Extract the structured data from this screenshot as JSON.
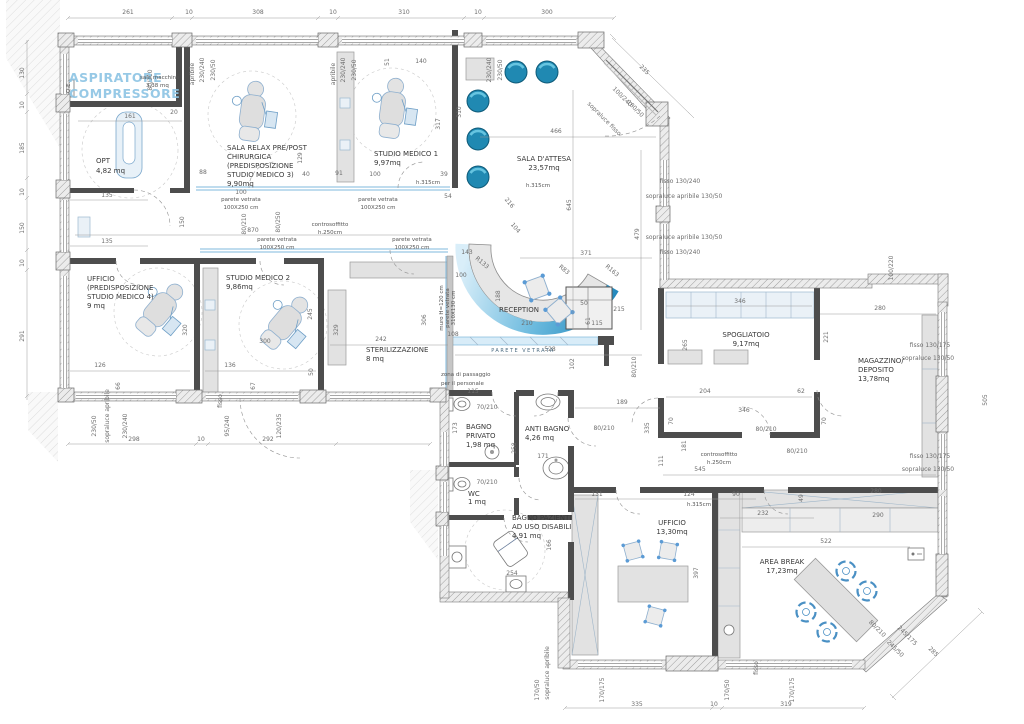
{
  "drawing": {
    "type": "architectural floor plan",
    "subject": "studio dentistico / medico",
    "units": "cm"
  },
  "colors": {
    "wall_dark": "#4d4d4d",
    "accent_blue": "#2e93c9",
    "chair_blue": "#2089b2",
    "glass_blue": "#7fb8dc",
    "aspiratore_text": "#8cc4e4",
    "dim_text": "#6d6d6d"
  },
  "rooms": {
    "sala_macchine": {
      "lines": [
        "ASPIRATORE",
        "COMPRESSORE"
      ],
      "sub": [
        "sala macchine",
        "3,38 mq"
      ]
    },
    "opt": {
      "name": "OPT",
      "area": "4,82 mq"
    },
    "sala_relax": {
      "lines": [
        "SALA RELAX PRE/POST",
        "CHIRURGICA",
        "(PREDISPOSIZIONE",
        "STUDIO MEDICO 3)",
        "9,90mq"
      ]
    },
    "studio1": {
      "name": "STUDIO MEDICO 1",
      "area": "9,97mq"
    },
    "sala_attesa": {
      "name": "SALA D'ATTESA",
      "area": "23,57mq"
    },
    "ufficio_predisp": {
      "lines": [
        "UFFICIO",
        "(PREDISPOSIZIONE",
        "STUDIO MEDICO 4)",
        "9 mq"
      ]
    },
    "studio2": {
      "name": "STUDIO MEDICO 2",
      "area": "9,86mq"
    },
    "sterilizzazione": {
      "name": "STERILIZZAZIONE",
      "area": "8 mq"
    },
    "reception": {
      "name": "RECEPTION"
    },
    "spogliatoio": {
      "name": "SPOGLIATOIO",
      "area": "9,17mq"
    },
    "magazzino": {
      "lines": [
        "MAGAZZINO/",
        "DEPOSITO",
        "13,78mq"
      ]
    },
    "bagno_privato": {
      "lines": [
        "BAGNO",
        "PRIVATO",
        "1,98 mq"
      ]
    },
    "anti_bagno": {
      "name": "ANTI BAGNO",
      "area": "4,26 mq"
    },
    "wc": {
      "name": "WC",
      "area": "1 mq"
    },
    "bagno_pazienti": {
      "lines": [
        "BAGNO PAZIENTI",
        "AD USO DISABILI",
        "4,91 mq"
      ]
    },
    "ufficio2": {
      "name": "UFFICIO",
      "area": "13,30mq"
    },
    "area_break": {
      "name": "AREA BREAK",
      "area": "17,23mq"
    }
  },
  "annotations": {
    "qe": "Q.E.",
    "h315": "h.315cm",
    "parete_vetrata": {
      "l1": "parete vetrata",
      "l2": "100X250 cm"
    },
    "parete_vetrata_caps": "PARETE VETRATA",
    "muro": {
      "l1": "muro H=120 cm",
      "l2": "parete vetrata",
      "l3": "310X130 cm"
    },
    "zona": {
      "l1": "zona di passaggio",
      "l2": "per il personale"
    },
    "controsoffitto": {
      "l1": "controsoffitto",
      "l2": "h.250cm"
    }
  },
  "dims": [
    {
      "x": 128,
      "y": 14,
      "t": "261"
    },
    {
      "x": 189,
      "y": 14,
      "t": "10"
    },
    {
      "x": 258,
      "y": 14,
      "t": "308"
    },
    {
      "x": 333,
      "y": 14,
      "t": "10"
    },
    {
      "x": 404,
      "y": 14,
      "t": "310"
    },
    {
      "x": 478,
      "y": 14,
      "t": "10"
    },
    {
      "x": 547,
      "y": 14,
      "t": "300"
    },
    {
      "x": 24,
      "y": 73,
      "t": "130",
      "r": -90
    },
    {
      "x": 24,
      "y": 105,
      "t": "10",
      "r": -90
    },
    {
      "x": 24,
      "y": 148,
      "t": "185",
      "r": -90
    },
    {
      "x": 24,
      "y": 192,
      "t": "10",
      "r": -90
    },
    {
      "x": 24,
      "y": 228,
      "t": "150",
      "r": -90
    },
    {
      "x": 24,
      "y": 263,
      "t": "10",
      "r": -90
    },
    {
      "x": 24,
      "y": 336,
      "t": "291",
      "r": -90
    },
    {
      "x": 134,
      "y": 441,
      "t": "298"
    },
    {
      "x": 201,
      "y": 441,
      "t": "10"
    },
    {
      "x": 268,
      "y": 441,
      "t": "292"
    },
    {
      "x": 96,
      "y": 426,
      "t": "230/50",
      "r": -90,
      "s": 5
    },
    {
      "x": 127,
      "y": 426,
      "t": "230/240",
      "r": -90,
      "s": 5
    },
    {
      "x": 229,
      "y": 426,
      "t": "95/240",
      "r": -90,
      "s": 5
    },
    {
      "x": 281,
      "y": 426,
      "t": "120/235",
      "r": -90,
      "s": 5
    },
    {
      "x": 109,
      "y": 416,
      "t": "sopraluce apribile",
      "r": -90,
      "s": 4
    },
    {
      "x": 222,
      "y": 401,
      "t": "fisso",
      "r": -90,
      "s": 4
    },
    {
      "x": 637,
      "y": 706,
      "t": "335"
    },
    {
      "x": 714,
      "y": 706,
      "t": "10"
    },
    {
      "x": 786,
      "y": 706,
      "t": "319"
    },
    {
      "x": 539,
      "y": 690,
      "t": "170/50",
      "r": -90,
      "s": 5
    },
    {
      "x": 604,
      "y": 690,
      "t": "170/175",
      "r": -90,
      "s": 5
    },
    {
      "x": 729,
      "y": 690,
      "t": "170/50",
      "r": -90,
      "s": 5
    },
    {
      "x": 794,
      "y": 690,
      "t": "170/175",
      "r": -90,
      "s": 5
    },
    {
      "x": 549,
      "y": 673,
      "t": "sopraluce apribile",
      "r": -90,
      "s": 4
    },
    {
      "x": 758,
      "y": 668,
      "t": "fisso",
      "r": -90,
      "s": 4
    },
    {
      "x": 204,
      "y": 70,
      "t": "230/240",
      "r": -90,
      "s": 4.5
    },
    {
      "x": 215,
      "y": 70,
      "t": "230/50",
      "r": -90,
      "s": 4.5
    },
    {
      "x": 345,
      "y": 70,
      "t": "230/240",
      "r": -90,
      "s": 4.5
    },
    {
      "x": 356,
      "y": 70,
      "t": "230/50",
      "r": -90,
      "s": 4.5
    },
    {
      "x": 491,
      "y": 70,
      "t": "230/240",
      "r": -90,
      "s": 4.5
    },
    {
      "x": 502,
      "y": 70,
      "t": "230/50",
      "r": -90,
      "s": 4.5
    },
    {
      "x": 194,
      "y": 74,
      "t": "apribile",
      "r": -90,
      "s": 4
    },
    {
      "x": 335,
      "y": 74,
      "t": "apribile",
      "r": -90,
      "s": 4
    },
    {
      "x": 643,
      "y": 71,
      "t": "235",
      "r": 45
    },
    {
      "x": 621,
      "y": 98,
      "t": "100/240",
      "r": 45,
      "s": 4.5
    },
    {
      "x": 634,
      "y": 110,
      "t": "180/50",
      "r": 45,
      "s": 4.5
    },
    {
      "x": 603,
      "y": 120,
      "t": "sopraluce fisso",
      "r": 45,
      "s": 4
    },
    {
      "x": 680,
      "y": 183,
      "t": "fisso 130/240",
      "s": 5
    },
    {
      "x": 684,
      "y": 198,
      "t": "sopraluce apribile 130/50",
      "s": 4.5
    },
    {
      "x": 684,
      "y": 239,
      "t": "sopraluce apribile 130/50",
      "s": 4.5
    },
    {
      "x": 680,
      "y": 254,
      "t": "fisso 130/240",
      "s": 5
    },
    {
      "x": 930,
      "y": 347,
      "t": "fisso 130/175",
      "s": 5,
      "a": "start"
    },
    {
      "x": 928,
      "y": 360,
      "t": "sopraluce 130/50",
      "s": 4.5,
      "a": "start"
    },
    {
      "x": 930,
      "y": 458,
      "t": "fisso 130/175",
      "s": 5,
      "a": "start"
    },
    {
      "x": 928,
      "y": 471,
      "t": "sopraluce 130/50",
      "s": 4.5,
      "a": "start"
    },
    {
      "x": 987,
      "y": 400,
      "t": "505",
      "r": -90
    },
    {
      "x": 893,
      "y": 268,
      "t": "100/220",
      "r": -90,
      "s": 4.5
    },
    {
      "x": 932,
      "y": 653,
      "t": "285",
      "r": 45
    },
    {
      "x": 906,
      "y": 637,
      "t": "245/175",
      "r": 45,
      "s": 4.5
    },
    {
      "x": 894,
      "y": 650,
      "t": "245/50",
      "r": 45,
      "s": 4.5
    },
    {
      "x": 876,
      "y": 630,
      "t": "80/210",
      "r": 45,
      "s": 4.5
    },
    {
      "x": 571,
      "y": 205,
      "t": "645",
      "r": -90
    },
    {
      "x": 639,
      "y": 234,
      "t": "479",
      "r": -90
    },
    {
      "x": 461,
      "y": 112,
      "t": "310",
      "r": -90,
      "s": 5
    },
    {
      "x": 440,
      "y": 124,
      "t": "317",
      "r": -90,
      "s": 5
    },
    {
      "x": 426,
      "y": 320,
      "t": "306",
      "r": -90
    },
    {
      "x": 338,
      "y": 330,
      "t": "329",
      "r": -90
    },
    {
      "x": 187,
      "y": 330,
      "t": "320",
      "r": -90
    },
    {
      "x": 312,
      "y": 314,
      "t": "245",
      "r": -90
    },
    {
      "x": 120,
      "y": 386,
      "t": "66",
      "r": -90,
      "s": 5
    },
    {
      "x": 255,
      "y": 386,
      "t": "67",
      "r": -90,
      "s": 5
    },
    {
      "x": 313,
      "y": 372,
      "t": "50",
      "r": -90,
      "s": 5
    },
    {
      "x": 184,
      "y": 222,
      "t": "150",
      "r": -90
    },
    {
      "x": 500,
      "y": 296,
      "t": "188",
      "r": -90,
      "s": 5
    },
    {
      "x": 574,
      "y": 364,
      "t": "102",
      "r": -90,
      "s": 5
    },
    {
      "x": 590,
      "y": 321,
      "t": "61",
      "r": -90,
      "s": 5
    },
    {
      "x": 649,
      "y": 428,
      "t": "335",
      "r": -90
    },
    {
      "x": 686,
      "y": 446,
      "t": "181",
      "r": -90,
      "s": 5
    },
    {
      "x": 663,
      "y": 461,
      "t": "111",
      "r": -90,
      "s": 5
    },
    {
      "x": 687,
      "y": 345,
      "t": "265",
      "r": -90
    },
    {
      "x": 828,
      "y": 337,
      "t": "221",
      "r": -90
    },
    {
      "x": 698,
      "y": 573,
      "t": "397",
      "r": -90
    },
    {
      "x": 803,
      "y": 498,
      "t": "49",
      "r": -90,
      "s": 5
    },
    {
      "x": 551,
      "y": 545,
      "t": "166",
      "r": -90,
      "s": 5
    },
    {
      "x": 457,
      "y": 428,
      "t": "173",
      "r": -90,
      "s": 5
    },
    {
      "x": 516,
      "y": 448,
      "t": "258",
      "r": -90,
      "s": 5
    },
    {
      "x": 246,
      "y": 224,
      "t": "80/210",
      "r": -90,
      "s": 4.5
    },
    {
      "x": 280,
      "y": 222,
      "t": "80/250",
      "r": -90,
      "s": 4.5
    },
    {
      "x": 152,
      "y": 80,
      "t": "80/210",
      "r": -90,
      "s": 4.5
    },
    {
      "x": 636,
      "y": 367,
      "t": "80/210",
      "r": -90,
      "s": 4.5
    },
    {
      "x": 130,
      "y": 118,
      "t": "161"
    },
    {
      "x": 174,
      "y": 114,
      "t": "20",
      "s": 5
    },
    {
      "x": 107,
      "y": 197,
      "t": "135"
    },
    {
      "x": 107,
      "y": 243,
      "t": "135"
    },
    {
      "x": 253,
      "y": 232,
      "t": "870"
    },
    {
      "x": 241,
      "y": 194,
      "t": "100",
      "s": 5
    },
    {
      "x": 375,
      "y": 176,
      "t": "100",
      "s": 5
    },
    {
      "x": 421,
      "y": 63,
      "t": "140"
    },
    {
      "x": 389,
      "y": 62,
      "t": "51",
      "r": -90,
      "s": 5
    },
    {
      "x": 203,
      "y": 174,
      "t": "88",
      "s": 5
    },
    {
      "x": 306,
      "y": 176,
      "t": "40",
      "s": 5
    },
    {
      "x": 339,
      "y": 175,
      "t": "91",
      "s": 5
    },
    {
      "x": 302,
      "y": 158,
      "t": "129",
      "r": -90,
      "s": 5
    },
    {
      "x": 444,
      "y": 176,
      "t": "39",
      "s": 5
    },
    {
      "x": 448,
      "y": 198,
      "t": "54",
      "s": 5
    },
    {
      "x": 556,
      "y": 133,
      "t": "466"
    },
    {
      "x": 586,
      "y": 255,
      "t": "371"
    },
    {
      "x": 467,
      "y": 254,
      "t": "143",
      "s": 5
    },
    {
      "x": 461,
      "y": 277,
      "t": "100",
      "s": 5
    },
    {
      "x": 381,
      "y": 341,
      "t": "242"
    },
    {
      "x": 527,
      "y": 325,
      "t": "210",
      "s": 5
    },
    {
      "x": 597,
      "y": 325,
      "t": "115",
      "s": 5
    },
    {
      "x": 584,
      "y": 305,
      "t": "50",
      "s": 5
    },
    {
      "x": 619,
      "y": 311,
      "t": "215"
    },
    {
      "x": 550,
      "y": 351,
      "t": "528"
    },
    {
      "x": 453,
      "y": 336,
      "t": "108",
      "s": 5
    },
    {
      "x": 622,
      "y": 404,
      "t": "189"
    },
    {
      "x": 705,
      "y": 393,
      "t": "204"
    },
    {
      "x": 801,
      "y": 393,
      "t": "62"
    },
    {
      "x": 740,
      "y": 303,
      "t": "346"
    },
    {
      "x": 744,
      "y": 412,
      "t": "346"
    },
    {
      "x": 673,
      "y": 421,
      "t": "70",
      "r": -90,
      "s": 5
    },
    {
      "x": 826,
      "y": 421,
      "t": "70",
      "r": -90,
      "s": 5
    },
    {
      "x": 700,
      "y": 471,
      "t": "545"
    },
    {
      "x": 597,
      "y": 496,
      "t": "131"
    },
    {
      "x": 689,
      "y": 496,
      "t": "124"
    },
    {
      "x": 736,
      "y": 496,
      "t": "90"
    },
    {
      "x": 763,
      "y": 515,
      "t": "232"
    },
    {
      "x": 880,
      "y": 310,
      "t": "280"
    },
    {
      "x": 876,
      "y": 493,
      "t": "280"
    },
    {
      "x": 878,
      "y": 517,
      "t": "290"
    },
    {
      "x": 826,
      "y": 543,
      "t": "522"
    },
    {
      "x": 473,
      "y": 393,
      "t": "115",
      "s": 5
    },
    {
      "x": 487,
      "y": 409,
      "t": "70/210",
      "s": 4.5
    },
    {
      "x": 487,
      "y": 484,
      "t": "70/210",
      "s": 4.5
    },
    {
      "x": 543,
      "y": 458,
      "t": "171",
      "s": 5
    },
    {
      "x": 604,
      "y": 430,
      "t": "80/210",
      "s": 4.5
    },
    {
      "x": 766,
      "y": 431,
      "t": "80/210",
      "s": 4.5
    },
    {
      "x": 797,
      "y": 453,
      "t": "80/210",
      "s": 4.5
    },
    {
      "x": 512,
      "y": 575,
      "t": "254",
      "s": 5
    },
    {
      "x": 100,
      "y": 367,
      "t": "126"
    },
    {
      "x": 230,
      "y": 367,
      "t": "136"
    },
    {
      "x": 265,
      "y": 343,
      "t": "300"
    },
    {
      "x": 481,
      "y": 264,
      "t": "R133",
      "r": 40,
      "s": 4.5
    },
    {
      "x": 563,
      "y": 271,
      "t": "R83",
      "r": 40,
      "s": 4.5
    },
    {
      "x": 611,
      "y": 272,
      "t": "R163",
      "r": 40,
      "s": 4.5
    },
    {
      "x": 508,
      "y": 204,
      "t": "216",
      "r": 50,
      "s": 4.5
    },
    {
      "x": 514,
      "y": 229,
      "t": "104",
      "r": 50,
      "s": 4.5
    }
  ]
}
